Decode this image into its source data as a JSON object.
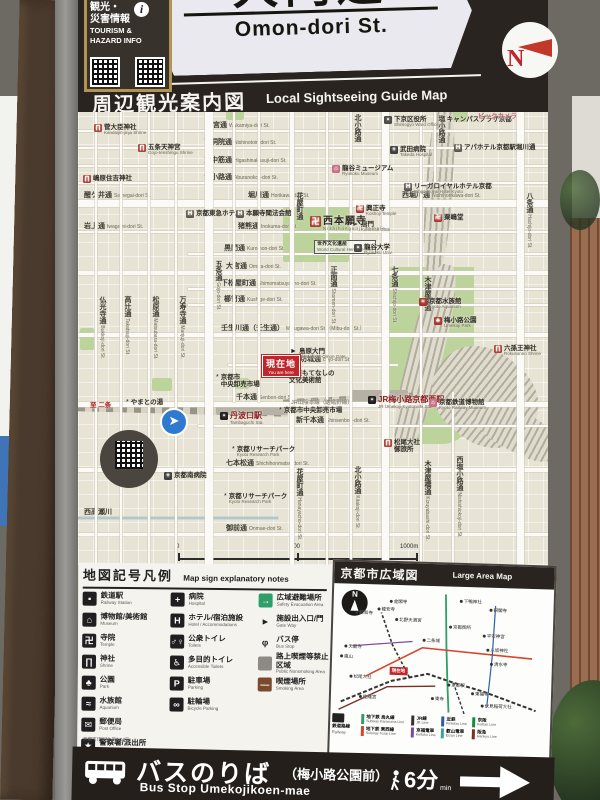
{
  "surroundings": {
    "pole_sign_text": "壬生川西入ル町"
  },
  "header": {
    "street_name_jp": "大門通",
    "street_name_en": "Omon-dori St.",
    "compass_letter": "N",
    "sticker": {
      "jp_line1": "観光・",
      "jp_line2": "災害情報",
      "info_symbol": "i",
      "en_line1": "TOURISM &",
      "en_line2": "HAZARD INFO"
    }
  },
  "guide_title": {
    "jp": "周辺観光案内図",
    "en": "Local Sightseeing Guide Map"
  },
  "map": {
    "you_are_here": {
      "jp": "現在地",
      "en": "You are here",
      "x": 184,
      "y": 243
    },
    "rail_line_note": "JR山陰本線（嵯峨野線）",
    "scale": {
      "start": "0",
      "mid": "500",
      "end": "1000m",
      "walk_jp": "徒歩約15分",
      "walk_en": "about 15 minutes on foot"
    },
    "streets_h": [
      {
        "y": 18,
        "labels": [
          {
            "jp": "若宮通",
            "en": "Wakamiya-dori St.",
            "x": 128
          }
        ]
      },
      {
        "y": 35,
        "labels": [
          {
            "jp": "西洞院通",
            "en": "Nishinotoin-dori St.",
            "x": 126
          }
        ]
      },
      {
        "y": 53,
        "labels": [
          {
            "jp": "東中筋通",
            "en": "Higashinakasuji-dori St.",
            "x": 126
          }
        ]
      },
      {
        "y": 70,
        "labels": [
          {
            "jp": "油小路通",
            "en": "Aburanokoji-dori St.",
            "x": 126
          }
        ]
      },
      {
        "y": 88,
        "h": 7,
        "labels": [
          {
            "jp": "醒ケ井通",
            "en": "Samegai-dori St.",
            "x": 6
          },
          {
            "jp": "堀川通",
            "en": "Horikawa-dori St.",
            "x": 170
          },
          {
            "jp": "西堀川通",
            "en": "Nishihorikawa-dori St.",
            "x": 324
          }
        ]
      },
      {
        "y": 119,
        "labels": [
          {
            "jp": "岩上通",
            "en": "Iwagami-dori St.",
            "x": 6
          },
          {
            "jp": "猪熊通",
            "en": "Inokuma-dori St.",
            "x": 160
          }
        ]
      },
      {
        "y": 141,
        "x1": 110,
        "labels": [
          {
            "jp": "黒門通",
            "en": "Kuromon-dori St.",
            "x": 146
          }
        ]
      },
      {
        "y": 159,
        "h": 4,
        "labels": [
          {
            "jp": "大宮通",
            "en": "Omiya-dori St.",
            "x": 148
          }
        ]
      },
      {
        "y": 176,
        "x1": 110,
        "labels": [
          {
            "jp": "下松屋町通",
            "en": "Shimomatsuyacho-dori St.",
            "x": 143
          }
        ]
      },
      {
        "y": 192,
        "x1": 110,
        "labels": [
          {
            "jp": "櫛笥通",
            "en": "Kushige-dori St.",
            "x": 146
          }
        ]
      },
      {
        "y": 221,
        "h": 4,
        "labels": [
          {
            "jp": "壬生川通（壬生通）",
            "en": "Mibugawa-dori St.（Mibu-dori St.）",
            "x": 143
          }
        ]
      },
      {
        "y": 252,
        "x1": 150,
        "x2": 320,
        "labels": [
          {
            "jp": "坊城通",
            "en": "Bojo-dori St.",
            "x": 222
          }
        ]
      },
      {
        "y": 290,
        "h": 5,
        "labels": [
          {
            "jp": "千本通",
            "en": "Senbon-dori St.",
            "x": 158
          }
        ]
      },
      {
        "y": 313,
        "x1": 120,
        "labels": [
          {
            "jp": "新千本通",
            "en": "Shinsenbon-dori St.",
            "x": 218
          }
        ]
      },
      {
        "y": 356,
        "h": 4,
        "labels": [
          {
            "jp": "七本松通",
            "en": "Shichihonmatsu-dori St.",
            "x": 148
          }
        ]
      },
      {
        "y": 405,
        "canal": true,
        "x2": 200,
        "labels": [
          {
            "jp": "西高瀬川",
            "x": 6
          }
        ]
      },
      {
        "y": 421,
        "h": 3,
        "labels": [
          {
            "jp": "御前通",
            "en": "Onmae-dori St.",
            "x": 148
          }
        ]
      }
    ],
    "streets_v": [
      {
        "x": 17,
        "labels": [
          {
            "jp": "仏光寺通",
            "en": "Bukkoji-dori St.",
            "y": 184
          }
        ]
      },
      {
        "x": 42,
        "labels": [
          {
            "jp": "高辻通",
            "en": "Takatsuji-dori St.",
            "y": 184
          }
        ]
      },
      {
        "x": 70,
        "labels": [
          {
            "jp": "松原通",
            "en": "Matsubara-dori St.",
            "y": 184
          }
        ]
      },
      {
        "x": 97,
        "labels": [
          {
            "jp": "万寿寺通",
            "en": "Manjuji-dori St.",
            "y": 184
          }
        ]
      },
      {
        "x": 127,
        "w": 8,
        "labels": [
          {
            "jp": "五条通",
            "en": "Gojo-dori St.",
            "y": 148
          }
        ]
      },
      {
        "x": 155,
        "y2": 290,
        "labels": []
      },
      {
        "x": 180,
        "y2": 290,
        "labels": []
      },
      {
        "x": 212,
        "w": 4,
        "labels": [
          {
            "jp": "花屋町通",
            "y": 80
          },
          {
            "jp": "花屋町通",
            "en": "Hanayacho-dori St.",
            "y": 356
          }
        ]
      },
      {
        "x": 248,
        "labels": [
          {
            "jp": "正面通",
            "en": "Shomen-dori St.",
            "y": 154
          }
        ]
      },
      {
        "x": 272,
        "labels": [
          {
            "jp": "北小路通",
            "y": 2
          },
          {
            "jp": "北小路通",
            "en": "Kitakoji-dori St.",
            "y": 354
          }
        ]
      },
      {
        "x": 304,
        "w": 7,
        "labels": [
          {
            "jp": "七条通",
            "en": "Shichijo-dori St.",
            "y": 154
          }
        ]
      },
      {
        "x": 342,
        "labels": [
          {
            "jp": "木津屋橋通",
            "y": 164
          },
          {
            "jp": "木津屋橋通",
            "en": "Kizuyabashi-dori St.",
            "y": 348
          }
        ]
      },
      {
        "x": 356,
        "y2": 70,
        "labels": [
          {
            "jp": "塩小路通",
            "y": 3
          }
        ]
      },
      {
        "x": 374,
        "y1": 280,
        "labels": [
          {
            "jp": "西塩小路通",
            "en": "Nishishiokoji-dori St.",
            "y": 344
          }
        ]
      },
      {
        "x": 439,
        "w": 7,
        "labels": [
          {
            "jp": "八条通",
            "en": "Hachijo-dori St.",
            "y": 80
          }
        ]
      }
    ],
    "pois": [
      {
        "jp": "菅大臣神社",
        "en": "Kandaijin-jinja Shrine",
        "x": 16,
        "y": 12,
        "t": "shrine"
      },
      {
        "jp": "五条天神宮",
        "en": "Gojo-tenshingu Shrine",
        "x": 60,
        "y": 32,
        "t": "shrine"
      },
      {
        "jp": "嶋原住吉神社",
        "x": 5,
        "y": 63,
        "t": "shrine"
      },
      {
        "jp": "京都東急ホテル",
        "x": 108,
        "y": 98,
        "t": "hotel"
      },
      {
        "jp": "本願寺聞法会館",
        "x": 158,
        "y": 98,
        "t": "hotel"
      },
      {
        "jp": "龍谷ミュージアム",
        "en": "Ryukoku Museum",
        "x": 254,
        "y": 53,
        "t": "museum"
      },
      {
        "jp": "下京区役所",
        "en": "Shimogyo Ward Office",
        "x": 306,
        "y": 4,
        "t": "office"
      },
      {
        "jp": "キャンパスプラザ京都",
        "x": 364,
        "y": 4,
        "t": "misc"
      },
      {
        "jp": "ビックカメラ",
        "x": 400,
        "y": 1,
        "t": "pink"
      },
      {
        "jp": "武田病院",
        "en": "Takeda Hospital",
        "x": 312,
        "y": 34,
        "t": "hospital"
      },
      {
        "jp": "アパホテル京都駅堀川通",
        "x": 376,
        "y": 32,
        "t": "hotel"
      },
      {
        "jp": "リーガロイヤルホテル京都",
        "en": "Rihga Royal Hotel Kyoto",
        "x": 326,
        "y": 71,
        "t": "hotel"
      },
      {
        "jp": "粟嶋堂",
        "x": 356,
        "y": 102,
        "t": "temple"
      },
      {
        "jp": "興正寺",
        "en": "Koshoji Temple",
        "x": 278,
        "y": 93,
        "t": "temple"
      },
      {
        "jp": "唐門",
        "en": "Karamon Gate",
        "x": 274,
        "y": 109,
        "t": "gate"
      },
      {
        "jp": "西本願寺",
        "en": "Nishihonganji Temple",
        "x": 232,
        "y": 104,
        "t": "temple",
        "big": true
      },
      {
        "jp": "世界文化遺産",
        "en": "World Cultural Heritage Site",
        "x": 236,
        "y": 128,
        "t": "box"
      },
      {
        "jp": "龍谷大学",
        "en": "Ryukoku Univ.",
        "x": 276,
        "y": 132,
        "t": "univ"
      },
      {
        "jp": "京都水族館",
        "en": "Kyoto Aquarium",
        "x": 341,
        "y": 186,
        "t": "aqua"
      },
      {
        "jp": "梅小路公園",
        "en": "Umekoji Park",
        "x": 356,
        "y": 205,
        "t": "park"
      },
      {
        "jp": "六孫王神社",
        "en": "Rokusonno Shrine",
        "x": 416,
        "y": 233,
        "t": "shrine"
      },
      {
        "jp": "島原大門",
        "en": "Shimabara-Omon Gate",
        "x": 212,
        "y": 236,
        "t": "gate"
      },
      {
        "jp": "輪違屋",
        "x": 192,
        "y": 249,
        "t": "misc"
      },
      {
        "jp": "角屋もてなしの|文化美術館",
        "x": 201,
        "y": 258,
        "t": "museum"
      },
      {
        "jp": "京都市|中央卸売市場",
        "x": 138,
        "y": 262,
        "t": "market"
      },
      {
        "jp": "丹波口駅",
        "en": "Tambaguchi Sta.",
        "x": 142,
        "y": 300,
        "t": "station"
      },
      {
        "jp": "京都市中央卸売市場",
        "x": 201,
        "y": 295,
        "t": "market"
      },
      {
        "jp": "やまとの湯",
        "x": 48,
        "y": 287,
        "t": "misc"
      },
      {
        "jp": "至 二条",
        "x": 12,
        "y": 290,
        "t": "dir"
      },
      {
        "jp": "京都リサーチパーク",
        "en": "Kyoto Research Park",
        "x": 154,
        "y": 334,
        "t": "misc"
      },
      {
        "jp": "京都南病院",
        "x": 86,
        "y": 360,
        "t": "hospital"
      },
      {
        "jp": "京都リサーチパーク",
        "en": "Kyoto Research Park",
        "x": 146,
        "y": 381,
        "t": "misc"
      },
      {
        "jp": "JR梅小路京都西駅",
        "en": "JR Umekoji-Kyotonishi Sta.",
        "x": 290,
        "y": 284,
        "t": "station"
      },
      {
        "jp": "京都鉄道博物館",
        "en": "Kyoto Railway Museum",
        "x": 351,
        "y": 287,
        "t": "museum"
      },
      {
        "jp": "松尾大社|御旅所",
        "x": 306,
        "y": 327,
        "t": "shrine"
      }
    ]
  },
  "legend": {
    "title_jp": "地図記号凡例",
    "title_en": "Map sign explanatory notes",
    "footnote": "京都市印刷物 第7-04号",
    "col1": [
      {
        "ic": "train",
        "jp": "鉄道駅",
        "en": "Railway Station"
      },
      {
        "ic": "museum",
        "jp": "博物館/美術館",
        "en": "Museum"
      },
      {
        "ic": "temple",
        "jp": "寺院",
        "en": "Temple"
      },
      {
        "ic": "shrine",
        "jp": "神社",
        "en": "Shrine"
      },
      {
        "ic": "park",
        "jp": "公園",
        "en": "Park"
      },
      {
        "ic": "aqua",
        "jp": "水族館",
        "en": "Aquarium"
      },
      {
        "ic": "post",
        "jp": "郵便局",
        "en": "Post Office"
      },
      {
        "ic": "police",
        "jp": "警察署/派出所",
        "en": "Police"
      }
    ],
    "col2": [
      {
        "ic": "hospital",
        "jp": "病院",
        "en": "Hospital"
      },
      {
        "ic": "hotel",
        "jp": "ホテル/宿泊施設",
        "en": "Hotel / Accommodations"
      },
      {
        "ic": "toilet",
        "jp": "公衆トイレ",
        "en": "Toilets"
      },
      {
        "ic": "accessible",
        "jp": "多目的トイレ",
        "en": "Accessible Toilets"
      },
      {
        "ic": "parking",
        "jp": "駐車場",
        "en": "Parking"
      },
      {
        "ic": "bicycle",
        "jp": "駐輪場",
        "en": "Bicycle Parking"
      }
    ],
    "col3": [
      {
        "ic": "evacuation",
        "jp": "広域避難場所",
        "en": "Safety Evacuation Area"
      },
      {
        "ic": "gateway",
        "jp": "施設出入口/門",
        "en": "Gate Way"
      },
      {
        "ic": "busstop",
        "jp": "バス停",
        "en": "Bus Stop"
      },
      {
        "ic": "nosmoke",
        "jp": "路上喫煙等禁止区域",
        "en": "Public Nonsmoking Area"
      },
      {
        "ic": "smoking",
        "jp": "喫煙場所",
        "en": "Smoking Area"
      }
    ]
  },
  "large_map": {
    "title_jp": "京都市広域図",
    "title_en": "Large Area Map",
    "compass_letter": "N",
    "you_are_here": "現在地",
    "places": [
      {
        "n": "金閣寺",
        "x": 56,
        "y": 14
      },
      {
        "n": "仁和寺",
        "x": 22,
        "y": 26
      },
      {
        "n": "龍安寺",
        "x": 44,
        "y": 22
      },
      {
        "n": "北野天満宮",
        "x": 62,
        "y": 32
      },
      {
        "n": "下鴨神社",
        "x": 126,
        "y": 12
      },
      {
        "n": "銀閣寺",
        "x": 156,
        "y": 20
      },
      {
        "n": "京都御所",
        "x": 116,
        "y": 38
      },
      {
        "n": "二条城",
        "x": 90,
        "y": 52
      },
      {
        "n": "平安神宮",
        "x": 150,
        "y": 46
      },
      {
        "n": "八坂神社",
        "x": 154,
        "y": 60
      },
      {
        "n": "清水寺",
        "x": 158,
        "y": 74
      },
      {
        "n": "天龍寺",
        "x": 12,
        "y": 60
      },
      {
        "n": "嵐山",
        "x": 8,
        "y": 70
      },
      {
        "n": "松尾大社",
        "x": 18,
        "y": 90
      },
      {
        "n": "桂離宮",
        "x": 28,
        "y": 110
      },
      {
        "n": "東寺",
        "x": 100,
        "y": 110
      },
      {
        "n": "京都駅",
        "x": 116,
        "y": 96
      },
      {
        "n": "東福寺",
        "x": 140,
        "y": 104
      },
      {
        "n": "伏見稲荷大社",
        "x": 150,
        "y": 116
      }
    ],
    "rail_legend_head": {
      "jp": "鉄道路線",
      "en": "Railway"
    },
    "rail_legend": [
      {
        "jp": "地下鉄 烏丸線",
        "en": "Subway Karasuma Line",
        "color": "#2f9e68"
      },
      {
        "jp": "地下鉄 東西線",
        "en": "Subway Tozai Line",
        "color": "#d9442c"
      },
      {
        "jp": "JR線",
        "en": "JR Line",
        "color": "#333333"
      },
      {
        "jp": "京福電車",
        "en": "Keifuku Line",
        "color": "#7a4a9e"
      },
      {
        "jp": "近鉄",
        "en": "Kintetsu Line",
        "color": "#2b5fa5"
      },
      {
        "jp": "叡山電車",
        "en": "Eizan Line",
        "color": "#3aa0a0"
      },
      {
        "jp": "京阪",
        "en": "Keihan Line",
        "color": "#1a8a3a"
      },
      {
        "jp": "阪急",
        "en": "Hankyu Line",
        "color": "#7b2d26"
      }
    ]
  },
  "bus_bar": {
    "jp": "バスのりば",
    "jp_sub": "（梅小路公園前）",
    "en": "Bus Stop Umekojikoen-mae",
    "walk_min": "6分",
    "walk_unit": "min"
  },
  "colors": {
    "board_dark": "#2a2420",
    "map_bg": "#e7e4d5",
    "park_green": "#bcd49c",
    "accent_red": "#c0272d",
    "station_red": "#8b1f24"
  }
}
